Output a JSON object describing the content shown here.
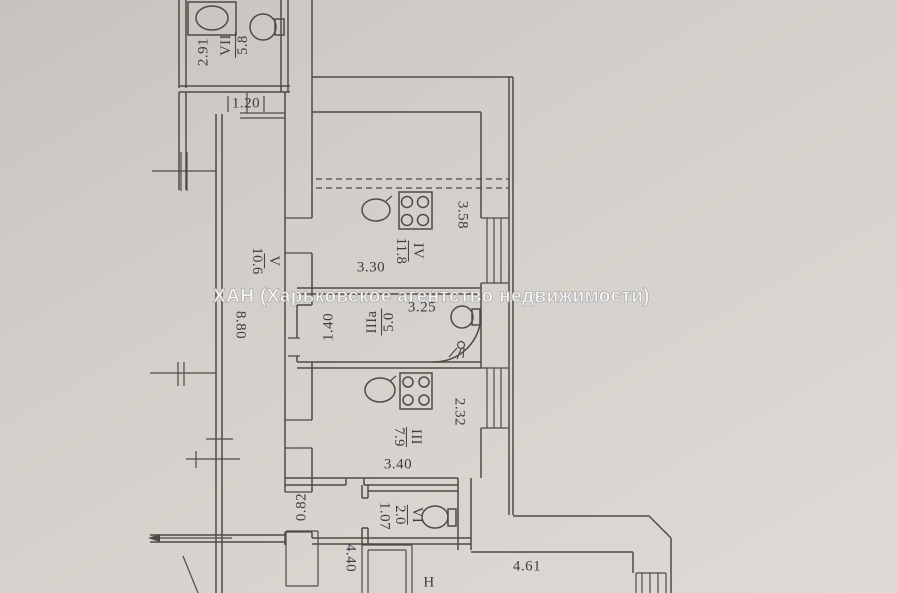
{
  "plan": {
    "watermark": "ХАН (Харьковское агентство недвижимости)",
    "rooms": {
      "vii": {
        "numeral": "VII",
        "area": "5.8"
      },
      "v": {
        "numeral": "V",
        "area": "10.6"
      },
      "iv": {
        "numeral": "IV",
        "area": "11.8"
      },
      "iiia": {
        "numeral": "IIIа",
        "area": "5.0"
      },
      "iii": {
        "numeral": "III",
        "area": "7.9"
      },
      "vi": {
        "numeral": "VI",
        "area": "2.0"
      }
    },
    "dimensions": {
      "room_vii_width": "2.91",
      "entry_opening": "1.20",
      "corridor_length": "8.80",
      "room_iv_width": "3.30",
      "room_iv_depth": "3.58",
      "room_iiia_width": "1.40",
      "room_iiia_length": "3.25",
      "room_iii_width": "3.40",
      "room_iii_depth": "2.32",
      "passage_width": "0.82",
      "room_vi_width": "1.07",
      "bottom_wall_left": "4.40",
      "bottom_wall_right": "4.61"
    },
    "partial_label": "Н",
    "colors": {
      "paper": "#d2cec9",
      "line": "#4e4a44",
      "text": "#3d3b45",
      "watermark": "#ffffff"
    }
  }
}
